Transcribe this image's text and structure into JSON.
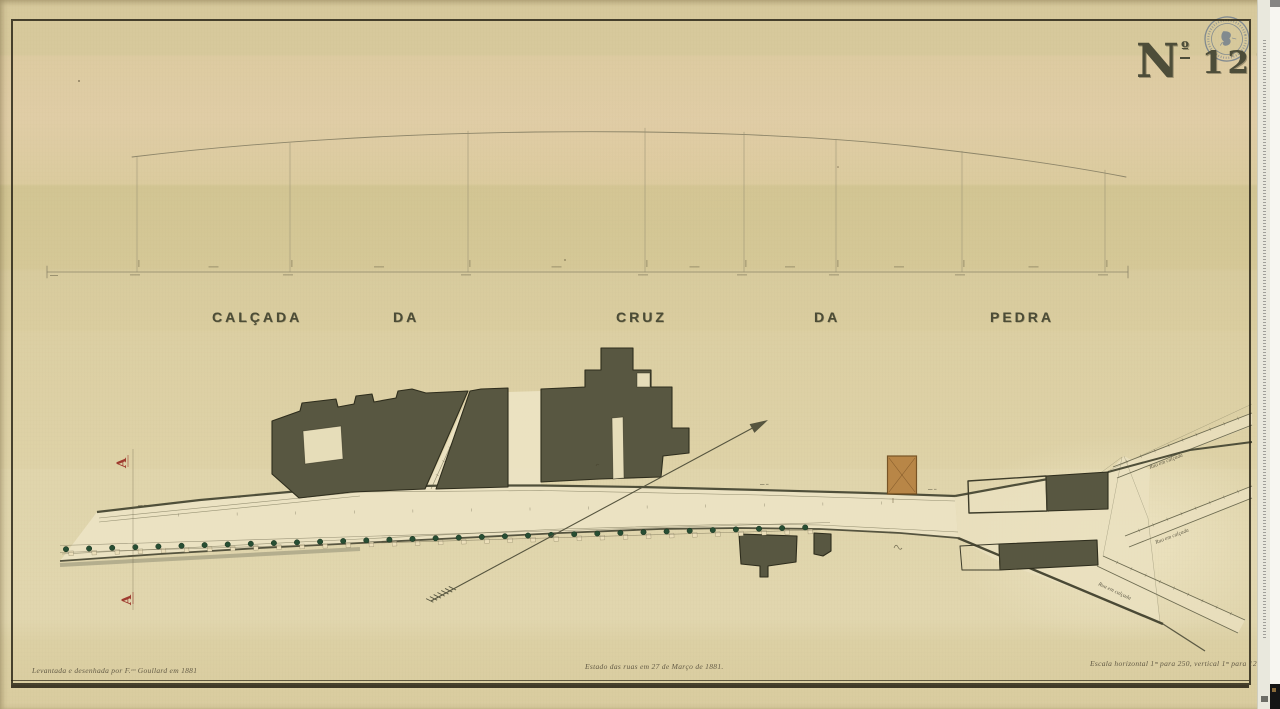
{
  "document": {
    "number_prefix": "N",
    "number_ordinal": "º",
    "number": "121",
    "title_words": [
      "CALÇADA",
      "DA",
      "CRUZ",
      "DA",
      "PEDRA"
    ],
    "captions": {
      "left": "Levantada e desenhada por F.ᶜᵒ Goullard em 1881",
      "center": "Estado das ruas em 27 de Março de 1881.",
      "right": "Escala horizontal 1ᵐ para 250, vertical 1ᵐ para 125."
    },
    "section_marker_top": "A",
    "section_marker_bottom": "A",
    "street_stub_label": "Rua em calçada"
  },
  "plan": {
    "tree_count": 33,
    "profile_ordinate_count": 8,
    "colors": {
      "paper": "#d8cb9e",
      "building_fill": "#585741",
      "building_outline": "#2e2d1d",
      "street_fill": "#ece3c4",
      "tree_green": "#274e33",
      "section_red": "#97271f",
      "proposed_block_orange": "#b5803f",
      "stamp_ink": "#6b7a8c",
      "number_ink": "#4d4d39"
    }
  }
}
